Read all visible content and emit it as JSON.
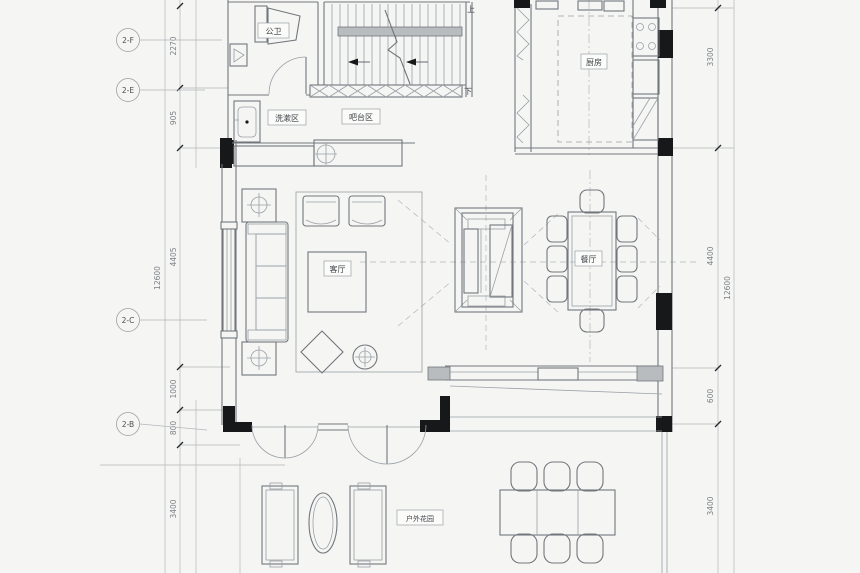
{
  "app": {
    "name": "architectural-floor-plan",
    "description": "residential first floor furniture layout plan (CAD drawing)"
  },
  "rooms": {
    "bathroom": "公卫",
    "wash_area": "洗漱区",
    "bar_area": "吧台区",
    "kitchen": "厨房",
    "living_room": "客厅",
    "dining_room": "餐厅",
    "outdoor_garden": "户外花园"
  },
  "stairs": {
    "up": "上",
    "down": "下"
  },
  "grid_bubbles": {
    "f": "2-F",
    "e": "2-E",
    "c": "2-C",
    "b": "2-B"
  },
  "dims_left": {
    "d1": "2270",
    "d2": "905",
    "d3": "4405",
    "d4": "1000",
    "d5": "800",
    "d6": "3400",
    "total": "12600"
  },
  "dims_right": {
    "d1": "3300",
    "d2": "4400",
    "d3": "600",
    "d4": "3400",
    "total": "12600"
  },
  "colors": {
    "paper": "#f5f5f4",
    "line": "#9aa0a6",
    "wall": "#72777c",
    "solid_wall": "#17181a",
    "text": "#4a4e52"
  }
}
